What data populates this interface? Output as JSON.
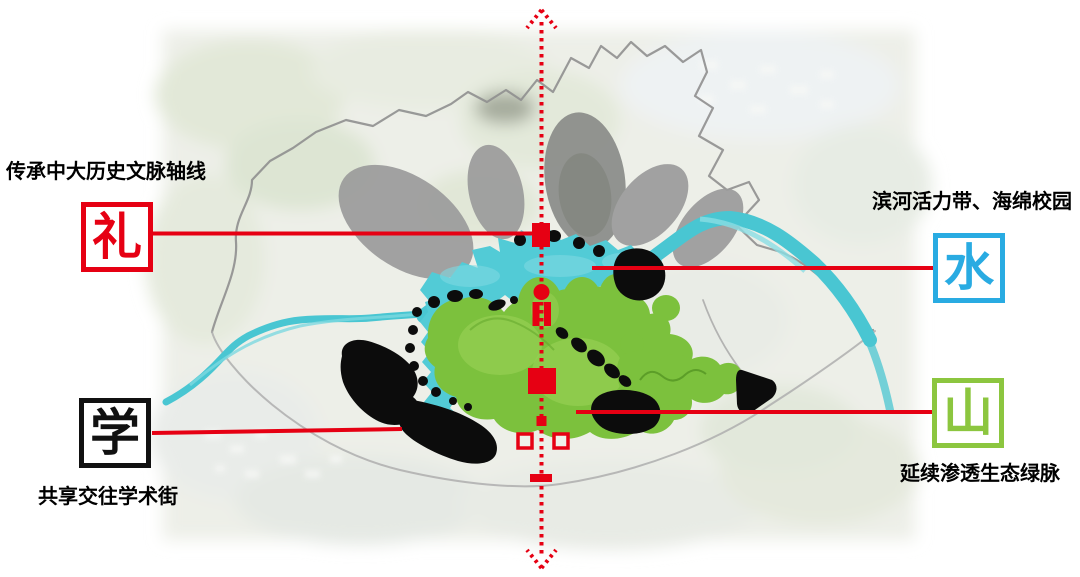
{
  "diagram": {
    "type": "campus-planning-concept-axis-diagram",
    "axis_color": "#e60013"
  },
  "concepts": [
    {
      "id": "li",
      "char": "礼",
      "color": "#e60013",
      "annotation": "传承中大历史文脉轴线"
    },
    {
      "id": "shui",
      "char": "水",
      "color": "#29abe2",
      "annotation": "滨河活力带、海绵校园"
    },
    {
      "id": "xue",
      "char": "学",
      "color": "#111111",
      "annotation": "共享交往学术街"
    },
    {
      "id": "shan",
      "char": "山",
      "color": "#8cc63f",
      "annotation": "延续渗透生态绿脉"
    }
  ],
  "map_palette": {
    "water_teal": "#4ac6d2",
    "green_hill": "#7cc13d",
    "building_black": "#0d0d0d",
    "expansion_gray": "#9a9a9a",
    "axis_red": "#e60013"
  }
}
